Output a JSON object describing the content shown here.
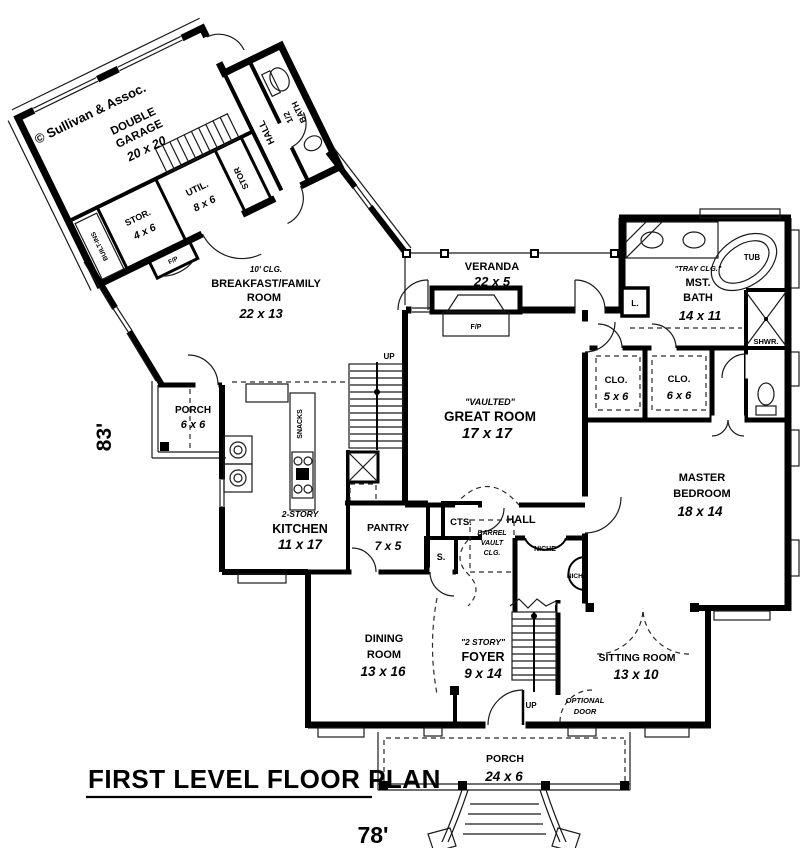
{
  "plan": {
    "title": "FIRST LEVEL FLOOR PLAN",
    "width_dim": "78'",
    "height_dim": "83'",
    "branding": "© Sullivan & Assoc."
  },
  "colors": {
    "wall": "#000000",
    "background": "#ffffff",
    "line": "#2a2a2a"
  },
  "rooms": {
    "garage": {
      "l1": "DOUBLE",
      "l2": "GARAGE",
      "size": "20 x 20"
    },
    "stor_4x6": {
      "name": "STOR.",
      "size": "4 x 6"
    },
    "util": {
      "name": "UTIL.",
      "size": "8 x 6"
    },
    "stor_small": {
      "name": "STOR"
    },
    "garage_hall": {
      "name": "HALL"
    },
    "half_bath": {
      "l1": "1/2",
      "l2": "BATH"
    },
    "built_ins": {
      "name": "BUILT-INS"
    },
    "fireplace_wing": {
      "name": "F/P"
    },
    "breakfast": {
      "clg": "10' CLG.",
      "l1": "BREAKFAST/FAMILY",
      "l2": "ROOM",
      "size": "22 x 13"
    },
    "veranda": {
      "name": "VERANDA",
      "size": "22 x 5"
    },
    "fireplace_great": {
      "name": "F/P"
    },
    "master_bath": {
      "clg": "\"TRAY CLG.\"",
      "l1": "MST.",
      "l2": "BATH",
      "size": "14 x 11"
    },
    "tub": {
      "name": "TUB"
    },
    "shower": {
      "name": "SHWR."
    },
    "linen": {
      "name": "L."
    },
    "closet_5x6": {
      "name": "CLO.",
      "size": "5 x 6"
    },
    "closet_6x6": {
      "name": "CLO.",
      "size": "6 x 6"
    },
    "great_room": {
      "clg": "\"VAULTED\"",
      "name": "GREAT ROOM",
      "size": "17 x 17"
    },
    "master_bedroom": {
      "l1": "MASTER",
      "l2": "BEDROOM",
      "size": "18 x 14"
    },
    "side_porch": {
      "name": "PORCH",
      "size": "6 x 6"
    },
    "kitchen": {
      "note": "2-STORY",
      "name": "KITCHEN",
      "size": "11 x 17"
    },
    "snacks": {
      "name": "SNACKS"
    },
    "pantry": {
      "name": "PANTRY",
      "size": "7 x 5"
    },
    "coats": {
      "name": "CTS."
    },
    "shelf": {
      "name": "S."
    },
    "hall": {
      "name": "HALL"
    },
    "barrel_vault": {
      "l1": "BARREL",
      "l2": "VAULT",
      "l3": "CLG."
    },
    "niche_a": {
      "name": "NICHE"
    },
    "niche_b": {
      "name": "NICHE"
    },
    "dining": {
      "l1": "DINING",
      "l2": "ROOM",
      "size": "13 x 16"
    },
    "foyer": {
      "note": "\"2 STORY\"",
      "name": "FOYER",
      "size": "9 x 14"
    },
    "stairs_up_main": {
      "name": "UP"
    },
    "stairs_up_foyer": {
      "name": "UP"
    },
    "sitting": {
      "name": "SITTING ROOM",
      "size": "13 x 10"
    },
    "optional_door": {
      "l1": "OPTIONAL",
      "l2": "DOOR"
    },
    "front_porch": {
      "name": "PORCH",
      "size": "24 x 6"
    }
  }
}
